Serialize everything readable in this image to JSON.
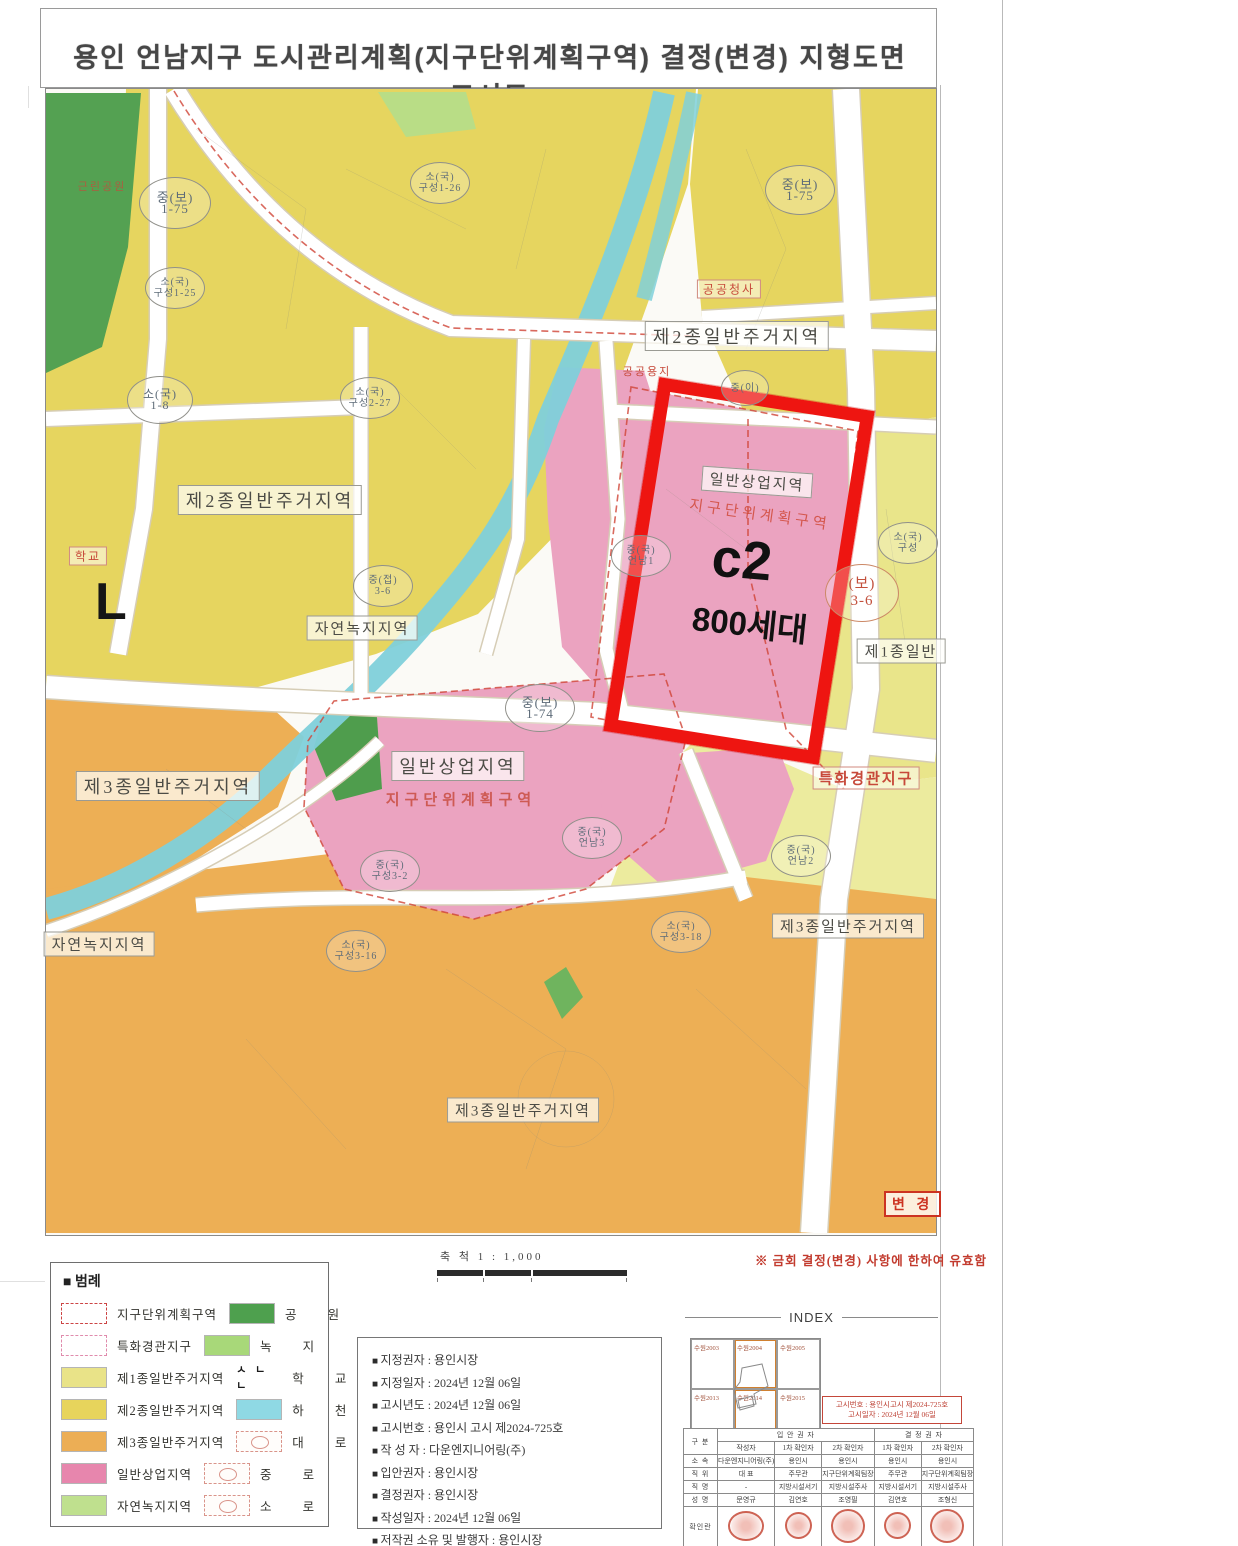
{
  "page": {
    "title": "용인 언남지구 도시관리계획(지구단위계획구역) 결정(변경) 지형도면고시도"
  },
  "map": {
    "zone_labels": [
      "제2종일반주거지역",
      "제2종일반주거지역",
      "제3종일반주거지역",
      "제3종일반주거지역",
      "제3종일반주거지역",
      "일반상업지역",
      "자연녹지지역",
      "자연녹지지역",
      "제1종일반"
    ],
    "red_labels": {
      "district": "지구단위계획구역",
      "scenic": "특화경관지구",
      "public_office": "공공청사",
      "public_land": "공공용지",
      "school": "학교",
      "park": "근린공원"
    },
    "highlight": {
      "zone": "일반상업지역",
      "district": "지구단위계획구역",
      "code": "c2",
      "units": "800세대"
    },
    "road_markers": [
      {
        "l1": "중(보)",
        "l2": "1-75"
      },
      {
        "l1": "소(국)",
        "l2": "구성1-25"
      },
      {
        "l1": "소(국)",
        "l2": "1-8"
      },
      {
        "l1": "소(국)",
        "l2": "구성1-26"
      },
      {
        "l1": "소(국)",
        "l2": "구성2-27"
      },
      {
        "l1": "중(보)",
        "l2": "1-75"
      },
      {
        "l1": "중(이)",
        "l2": ""
      },
      {
        "l1": "중(접)",
        "l2": "3-6"
      },
      {
        "l1": "(보)",
        "l2": "3-6"
      },
      {
        "l1": "중(보)",
        "l2": "1-74"
      },
      {
        "l1": "중(국)",
        "l2": "언남1"
      },
      {
        "l1": "중(국)",
        "l2": "언남3"
      },
      {
        "l1": "중(국)",
        "l2": "구성3-2"
      },
      {
        "l1": "소(국)",
        "l2": "구성3-16"
      },
      {
        "l1": "중(국)",
        "l2": "언남2"
      },
      {
        "l1": "소(국)",
        "l2": "구성3-18"
      },
      {
        "l1": "소(국)",
        "l2": "구성"
      }
    ],
    "change_stamp": "변 경"
  },
  "scale": {
    "label": "축 척 1 : 1,000"
  },
  "note": "※ 금회 결정(변경) 사항에 한하여 유효함",
  "legend": {
    "title": "■ 범례",
    "school_icon": "ㅅ ㄴ ㄴ",
    "left": [
      {
        "label": "지구단위계획구역"
      },
      {
        "label": "특화경관지구"
      },
      {
        "label": "제1종일반주거지역"
      },
      {
        "label": "제2종일반주거지역"
      },
      {
        "label": "제3종일반주거지역"
      },
      {
        "label": "일반상업지역"
      },
      {
        "label": "자연녹지지역"
      }
    ],
    "right": [
      {
        "label": "공 원"
      },
      {
        "label": "녹 지"
      },
      {
        "label": "학 교"
      },
      {
        "label": "하 천"
      },
      {
        "label": "대 로"
      },
      {
        "label": "중 로"
      },
      {
        "label": "소 로"
      }
    ]
  },
  "info": {
    "items": [
      "지정권자 : 용인시장",
      "지정일자 : 2024년 12월 06일",
      "고시년도 : 2024년 12월 06일",
      "고시번호 : 용인시 고시 제2024-725호",
      "작 성 자 : 다운엔지니어링(주)",
      "입안권자 : 용인시장",
      "결정권자 : 용인시장",
      "작성일자 : 2024년 12월 06일",
      "저작권 소유 및 발행자 : 용인시장"
    ]
  },
  "index": {
    "title": "INDEX",
    "cells": [
      "수원2003",
      "수원2004",
      "수원2005",
      "수원2013",
      "수원2014",
      "수원2015"
    ]
  },
  "notice": {
    "line1": "고시번호 : 용인시고시 제2024-725호",
    "line2": "고시일자 : 2024년 12월 06일"
  },
  "sign_table": {
    "corner": "구 분",
    "group1": "입 안 권 자",
    "group2": "결 정 권 자",
    "roles": [
      "작성자",
      "1차 확인자",
      "2차 확인자",
      "1차 확인자",
      "2차 확인자"
    ],
    "rows": [
      {
        "label": "소 속",
        "values": [
          "다운엔지니어링(주)",
          "용인시",
          "용인시",
          "용인시",
          "용인시"
        ]
      },
      {
        "label": "직 위",
        "values": [
          "대 표",
          "주무관",
          "지구단위계획팀장",
          "주무관",
          "지구단위계획팀장"
        ]
      },
      {
        "label": "직 명",
        "values": [
          "-",
          "지방시설서기",
          "지방시설주사",
          "지방시설서기",
          "지방시설주사"
        ]
      },
      {
        "label": "성 명",
        "values": [
          "문영규",
          "김연호",
          "조영필",
          "김연호",
          "조형신"
        ]
      }
    ],
    "stamp_row_label": "확인란"
  },
  "colors": {
    "red_box": "#ee1511",
    "zone_yellow_2nd": "#e6d55f",
    "zone_pale_1st": "#e9e58a",
    "zone_orange_3rd": "#edaf55",
    "zone_pink_commercial": "#eba3c0",
    "zone_park_green": "#54a152",
    "zone_nature_green": "#b9dd86",
    "river_cyan": "#7fd0da",
    "stamp_red": "#c54a38"
  }
}
